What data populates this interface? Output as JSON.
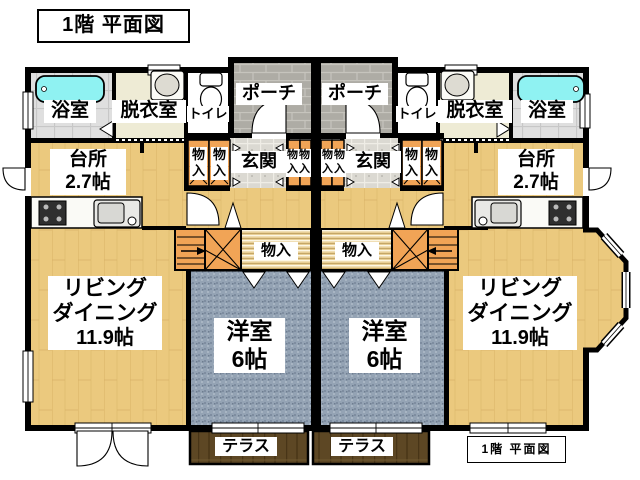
{
  "title": "1階  平面図",
  "footer": "1階  平面図",
  "labels": {
    "bath": "浴室",
    "dressing": "脱衣室",
    "toilet": "トイレ",
    "porch": "ポーチ",
    "entrance": "玄関",
    "storage": "物入",
    "kitchen": "台所",
    "kitchen_size": "2.7帖",
    "living_l1": "リビング",
    "living_l2": "ダイニング",
    "living_size": "11.9帖",
    "western": "洋室",
    "western_size": "6帖",
    "terrace": "テラス"
  },
  "colors": {
    "wood_floor": "#EBC97E",
    "carpet": "#94A3B4",
    "porch_brick": "#AEACA5",
    "entry_tile": "#DBD9D2",
    "bath_tile": "#DFDFDF",
    "cream_floor": "#EEEBD5",
    "bathtub": "#8FF2F2",
    "closet_wood": "#F1A456",
    "terrace_wood": "#5D4724",
    "wall": "#000000",
    "background": "#FFFFFF"
  }
}
